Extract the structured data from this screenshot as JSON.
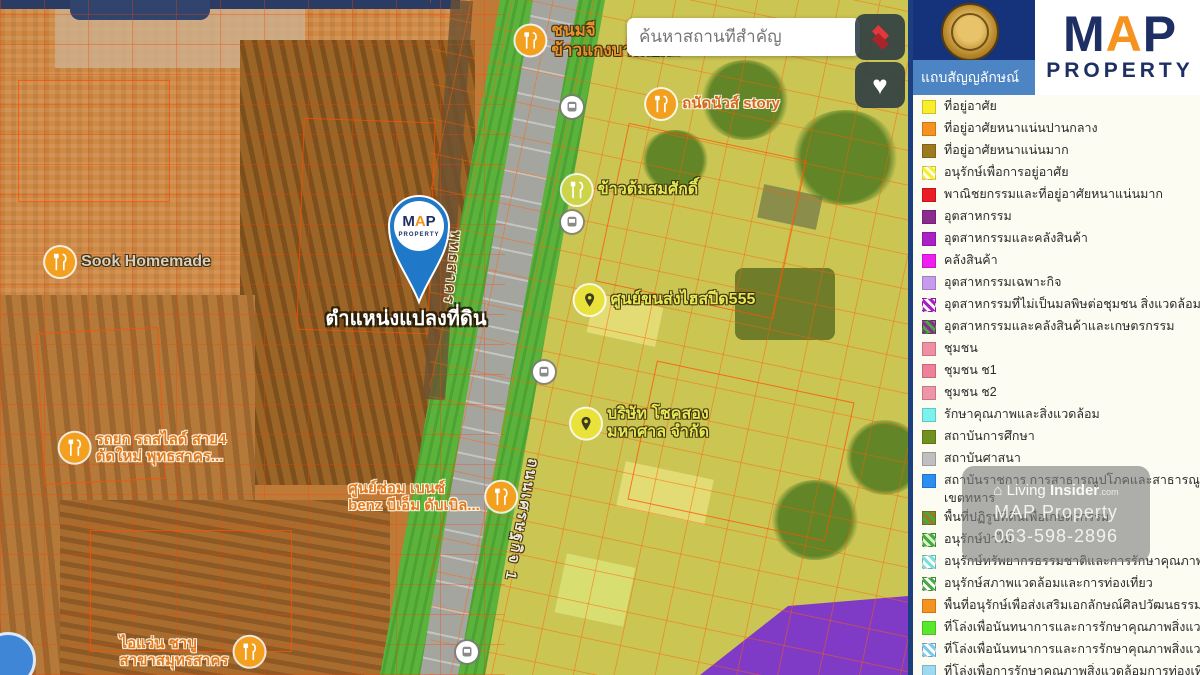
{
  "panel": {
    "title": "แถบสัญญลักษณ์"
  },
  "logo": {
    "m": "M",
    "a": "A",
    "p": "P",
    "subtitle": "PROPERTY"
  },
  "search": {
    "placeholder": "ค้นหาสถานที่สำคัญ"
  },
  "controls": {
    "layers_icon": "layers",
    "favorite_icon": "heart",
    "heart_glyph": "♥"
  },
  "watermark": {
    "house_glyph": "⌂",
    "brand_prefix": "Living ",
    "brand_bold": "Insider",
    "brand_suffix": ".com",
    "line2": "MAP Property",
    "phone": "063-598-2896"
  },
  "map": {
    "pin_label": "ตำแหน่งแปลงที่ดิน",
    "accent_pin_color": "#1f78c8",
    "road_labels": [
      {
        "text": "พุทธสาคร",
        "x": 452,
        "y": 268,
        "rotate": 96,
        "color": "#6b4a16",
        "size": 14,
        "halo": "light"
      },
      {
        "text": "ถนนเศรษฐกิจ 1",
        "x": 522,
        "y": 520,
        "rotate": 101,
        "color": "#efe8d6",
        "size": 15,
        "halo": "dark"
      }
    ],
    "pois": [
      {
        "icon": "food",
        "icon_bg": "#f3a01f",
        "side": "right",
        "x": 598,
        "y": 40,
        "color": "#e8922e",
        "halo": "dark",
        "size": 17,
        "lines": [
          "ชนมจี",
          "ข้าวแกงบางกอก.."
        ]
      },
      {
        "icon": "food",
        "icon_bg": "#f3a01f",
        "side": "right",
        "x": 713,
        "y": 104,
        "color": "#d2691e",
        "halo": "light",
        "size": 15,
        "lines": [
          "ถนัดนัวส์ story"
        ]
      },
      {
        "icon": "food",
        "icon_bg": "#cdd44a",
        "side": "right",
        "x": 630,
        "y": 190,
        "color": "#e4ea55",
        "halo": "dark",
        "size": 16,
        "lines": [
          "ข้าวต้มสมศักดิ์"
        ]
      },
      {
        "icon": "pin",
        "icon_bg": "#e8e23a",
        "side": "right",
        "x": 665,
        "y": 300,
        "color": "#e4ea55",
        "halo": "dark",
        "size": 16,
        "lines": [
          "ศูนย์ขนส่งไฮสปีด555"
        ]
      },
      {
        "icon": "pin",
        "icon_bg": "#e8e23a",
        "side": "right",
        "x": 640,
        "y": 424,
        "color": "#e4ea55",
        "halo": "dark",
        "size": 16,
        "lines": [
          "บริษัท โชคสอง",
          "มหาศาล จำกัด"
        ]
      },
      {
        "icon": "food",
        "icon_bg": "#f3a01f",
        "side": "right",
        "x": 128,
        "y": 262,
        "color": "#d8cfc0",
        "halo": "dark",
        "size": 16,
        "lines": [
          "Sook Homemade"
        ]
      },
      {
        "icon": "food",
        "icon_bg": "#f3a01f",
        "side": "right",
        "x": 143,
        "y": 448,
        "color": "#e07a20",
        "halo": "light",
        "size": 15,
        "lines": [
          "รถยก รถสไลด์ สาย4",
          "ตัดใหม่ พุทธสาคร..."
        ]
      },
      {
        "icon": "food",
        "icon_bg": "#f3a01f",
        "side": "left",
        "x": 432,
        "y": 497,
        "color": "#e07a20",
        "halo": "light",
        "size": 15,
        "lines": [
          "ศูนย์ซ่อม เบนซ์",
          "benz บีเอ็ม ดับเบิล..."
        ]
      },
      {
        "icon": "food",
        "icon_bg": "#f3a01f",
        "side": "left",
        "x": 192,
        "y": 652,
        "color": "#e07a20",
        "halo": "light",
        "size": 15,
        "lines": [
          "ไอแว่น ชาบู",
          "สาขาสมุทรสาคร"
        ]
      },
      {
        "icon": "transit",
        "icon_bg": "#ffffff",
        "side": "right",
        "x": 575,
        "y": 107,
        "lines": []
      },
      {
        "icon": "transit",
        "icon_bg": "#ffffff",
        "side": "right",
        "x": 575,
        "y": 222,
        "lines": []
      },
      {
        "icon": "transit",
        "icon_bg": "#ffffff",
        "side": "right",
        "x": 547,
        "y": 372,
        "lines": []
      },
      {
        "icon": "transit",
        "icon_bg": "#ffffff",
        "side": "right",
        "x": 470,
        "y": 652,
        "lines": []
      }
    ]
  },
  "legend": {
    "items": [
      {
        "label": "ที่อยู่อาศัย",
        "color": "#f9ee2b"
      },
      {
        "label": "ที่อยู่อาศัยหนาแน่นปานกลาง",
        "color": "#f6921e"
      },
      {
        "label": "ที่อยู่อาศัยหนาแน่นมาก",
        "color": "#9c7a1d"
      },
      {
        "label": "อนุรักษ์เพื่อการอยู่อาศัย",
        "stripes": [
          "#f9ee2b",
          "#fffdea"
        ]
      },
      {
        "label": "พาณิชยกรรมและที่อยู่อาศัยหนาแน่นมาก",
        "color": "#ec1c24"
      },
      {
        "label": "อุตสาหกรรม",
        "color": "#8b2b8d"
      },
      {
        "label": "อุตสาหกรรมและคลังสินค้า",
        "color": "#ad1fc6"
      },
      {
        "label": "คลังสินค้า",
        "color": "#ef1def"
      },
      {
        "label": "อุตสาหกรรมเฉพาะกิจ",
        "color": "#c69ced"
      },
      {
        "label": "อุตสาหกรรมที่ไม่เป็นมลพิษต่อชุมชน สิ่งแวดล้อมและ...",
        "stripes": [
          "#ad1fc6",
          "#ffffff"
        ]
      },
      {
        "label": "อุตสาหกรรมและคลังสินค้าและเกษตรกรรม",
        "stripes": [
          "#8b2b8d",
          "#49a942"
        ]
      },
      {
        "label": "ชุมชน",
        "color": "#f08fa2"
      },
      {
        "label": "ชุมชน  ช1",
        "color": "#ee8097"
      },
      {
        "label": "ชุมชน  ช2",
        "color": "#ef94a9"
      },
      {
        "label": "รักษาคุณภาพและสิ่งแวดล้อม",
        "color": "#7af3ec"
      },
      {
        "label": "สถาบันการศึกษา",
        "color": "#70901f"
      },
      {
        "label": "สถาบันศาสนา",
        "color": "#bfbfbf"
      },
      {
        "label": "สถาบันราชการ การสาธารณูปโภคและสาธารณูปการ",
        "label2": "เขตทหาร",
        "color": "#2b8ef0"
      },
      {
        "label": "พื้นที่ปฏิรูปที่ดินเพื่อเกษตรกรรม",
        "stripes": [
          "#9c7a1d",
          "#49a942"
        ]
      },
      {
        "label": "อนุรักษ์ป่าไม้",
        "stripes": [
          "#49a942",
          "#d8f5c8"
        ]
      },
      {
        "label": "อนุรักษ์ทรัพยากรธรรมชาติและการรักษาคุณภาพสิ่งแวดล้อม",
        "stripes": [
          "#7ae0d8",
          "#ffffff"
        ]
      },
      {
        "label": "อนุรักษ์สภาพแวดล้อมและการท่องเที่ยว",
        "stripes": [
          "#49a942",
          "#ffffff"
        ]
      },
      {
        "label": "พื้นที่อนุรักษ์เพื่อส่งเสริมเอกลักษณ์ศิลปวัฒนธรรมไทย",
        "color": "#f6921e"
      },
      {
        "label": "ที่โล่งเพื่อนันทนาการและการรักษาคุณภาพสิ่งแวดล้อม",
        "color": "#5ae82e"
      },
      {
        "label": "ที่โล่งเพื่อนันทนาการและการรักษาคุณภาพสิ่งแวดล้อม",
        "stripes": [
          "#7ec8f0",
          "#ffffff"
        ]
      },
      {
        "label": "ที่โล่งเพื่อการรักษาคุณภาพสิ่งแวดล้อมการท่องเที่ยว",
        "color": "#9ed9f2"
      },
      {
        "label": "ที่โล่งเพื่อการรักษาคุณภาพสิ่งแวดล้อม...",
        "color": "#49a942"
      }
    ]
  }
}
